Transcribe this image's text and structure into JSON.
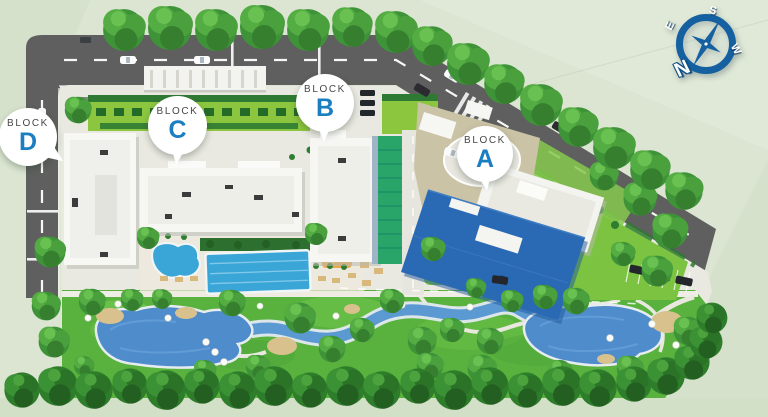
{
  "plan": {
    "kind": "residential master plan site map",
    "labels": {
      "block_prefix": "BLOCK",
      "blocks": [
        {
          "id": "block-d",
          "letter": "D"
        },
        {
          "id": "block-c",
          "letter": "C"
        },
        {
          "id": "block-b",
          "letter": "B"
        },
        {
          "id": "block-a",
          "letter": "A"
        }
      ]
    },
    "compass": {
      "north": "N",
      "south": "S",
      "east": "E",
      "west": "W"
    },
    "icons": {
      "compass": "compass-rose-icon"
    },
    "palette": {
      "background_green": "#dbe5d2",
      "road_gray": "#5e5f5e",
      "pavement": "#e9e8e1",
      "lawn_green": "#8cc63e",
      "park_green": "#58b23d",
      "pool_blue": "#3aa6d8",
      "lake_blue": "#4e8ccb",
      "block_a_roof_blue": "#2a69b4",
      "label_letter_blue": "#1b7ec1",
      "label_text_gray": "#474747",
      "compass_blue": "#1460a0"
    }
  }
}
